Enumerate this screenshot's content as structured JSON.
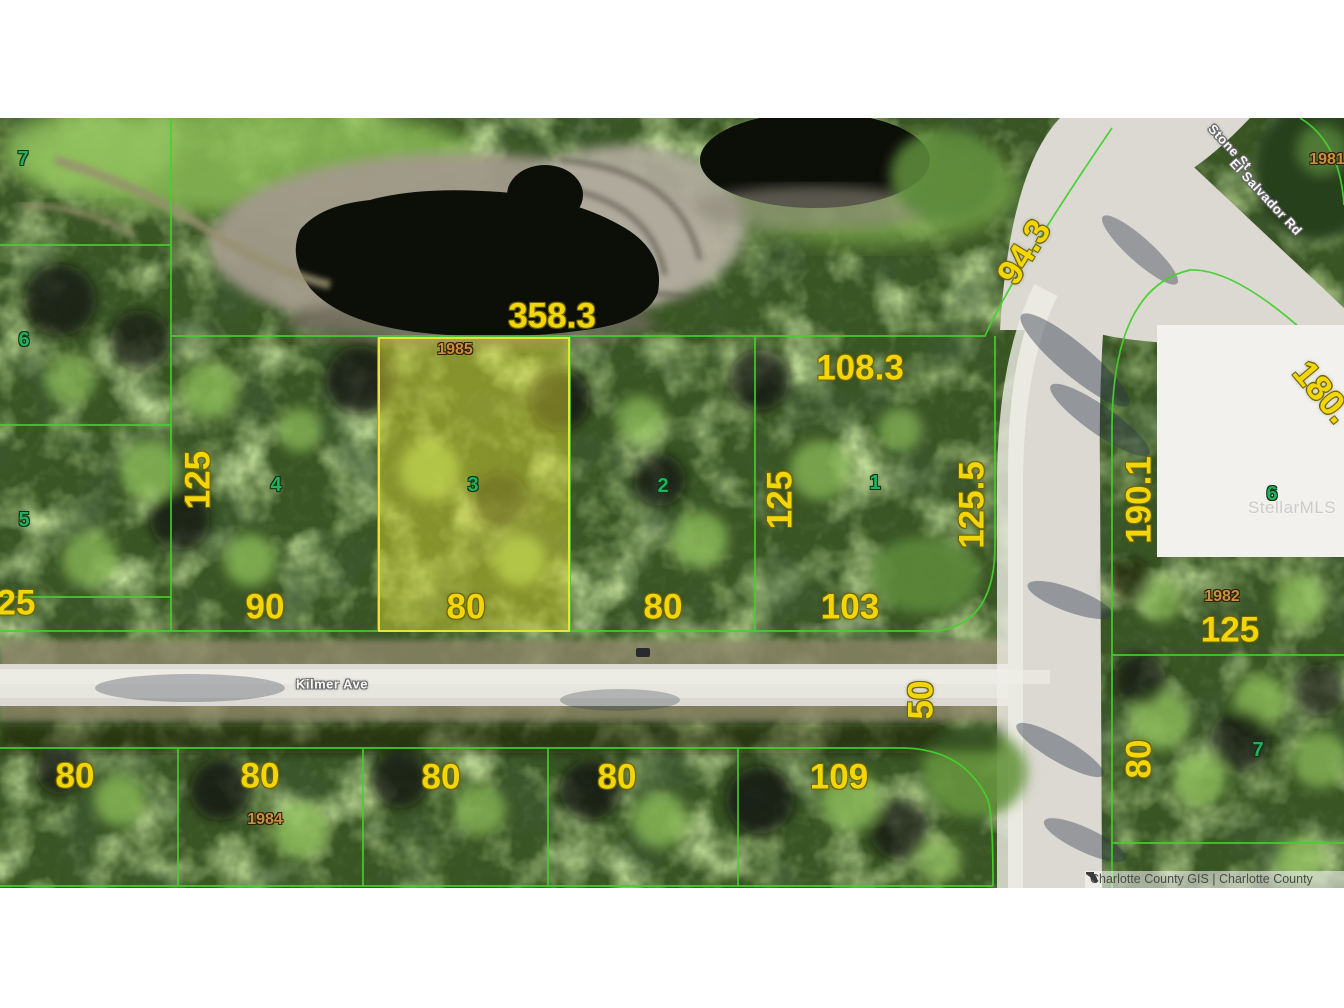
{
  "map": {
    "attribution": {
      "text": "Charlotte County GIS | Charlotte County",
      "icon": "florida-state-icon"
    },
    "watermark": "StellarMLS",
    "highlighted_parcel": {
      "parcel_number": "3",
      "block_year": "1985",
      "frontage": "80",
      "top_dimension": "358.3"
    },
    "streets": [
      {
        "label": "Kilmer Ave",
        "x": 332,
        "y": 684,
        "rot": 0
      },
      {
        "label": "Stone St",
        "x": 1230,
        "y": 147,
        "rot": 47
      },
      {
        "label": "El Salvador Rd",
        "x": 1266,
        "y": 197,
        "rot": 47
      }
    ],
    "dimension_labels": [
      {
        "text": "358.3",
        "x": 552,
        "y": 316,
        "rot": 0
      },
      {
        "text": "108.3",
        "x": 860,
        "y": 368,
        "rot": 0
      },
      {
        "text": "94.3",
        "x": 1024,
        "y": 252,
        "rot": -58
      },
      {
        "text": "125",
        "x": 198,
        "y": 480,
        "rot": -90
      },
      {
        "text": "125",
        "x": 780,
        "y": 500,
        "rot": -90
      },
      {
        "text": "125.5",
        "x": 972,
        "y": 505,
        "rot": -90
      },
      {
        "text": "190.1",
        "x": 1139,
        "y": 500,
        "rot": -90
      },
      {
        "text": "180.",
        "x": 1322,
        "y": 392,
        "rot": 50
      },
      {
        "text": "25",
        "x": 16,
        "y": 603,
        "rot": 0
      },
      {
        "text": "90",
        "x": 265,
        "y": 607,
        "rot": 0
      },
      {
        "text": "80",
        "x": 466,
        "y": 607,
        "rot": 0
      },
      {
        "text": "80",
        "x": 663,
        "y": 607,
        "rot": 0
      },
      {
        "text": "103",
        "x": 850,
        "y": 607,
        "rot": 0
      },
      {
        "text": "50",
        "x": 921,
        "y": 700,
        "rot": -90
      },
      {
        "text": "80",
        "x": 75,
        "y": 776,
        "rot": 0
      },
      {
        "text": "80",
        "x": 260,
        "y": 776,
        "rot": 0
      },
      {
        "text": "80",
        "x": 441,
        "y": 777,
        "rot": 0
      },
      {
        "text": "80",
        "x": 617,
        "y": 777,
        "rot": 0
      },
      {
        "text": "109",
        "x": 839,
        "y": 777,
        "rot": 0
      },
      {
        "text": "125",
        "x": 1230,
        "y": 630,
        "rot": 0
      },
      {
        "text": "80",
        "x": 1139,
        "y": 759,
        "rot": -90
      }
    ],
    "parcel_numbers": [
      {
        "text": "7",
        "x": 23,
        "y": 159
      },
      {
        "text": "6",
        "x": 24,
        "y": 340
      },
      {
        "text": "5",
        "x": 24,
        "y": 520
      },
      {
        "text": "4",
        "x": 276,
        "y": 485
      },
      {
        "text": "3",
        "x": 473,
        "y": 485
      },
      {
        "text": "2",
        "x": 663,
        "y": 486
      },
      {
        "text": "1",
        "x": 875,
        "y": 483
      },
      {
        "text": "6",
        "x": 1272,
        "y": 494
      },
      {
        "text": "7",
        "x": 1258,
        "y": 750
      }
    ],
    "year_labels": [
      {
        "text": "1985",
        "x": 455,
        "y": 350
      },
      {
        "text": "1981",
        "x": 1327,
        "y": 160
      },
      {
        "text": "1982",
        "x": 1222,
        "y": 597
      },
      {
        "text": "1984",
        "x": 265,
        "y": 820
      }
    ],
    "colors": {
      "dimension_text": "#f3d608",
      "parcel_number_text": "#23b05d",
      "year_text": "#c98f3c",
      "parcel_line": "#46d02e",
      "highlight_fill": "rgba(233,228,58,0.44)",
      "highlight_border": "#e8e23a"
    }
  }
}
